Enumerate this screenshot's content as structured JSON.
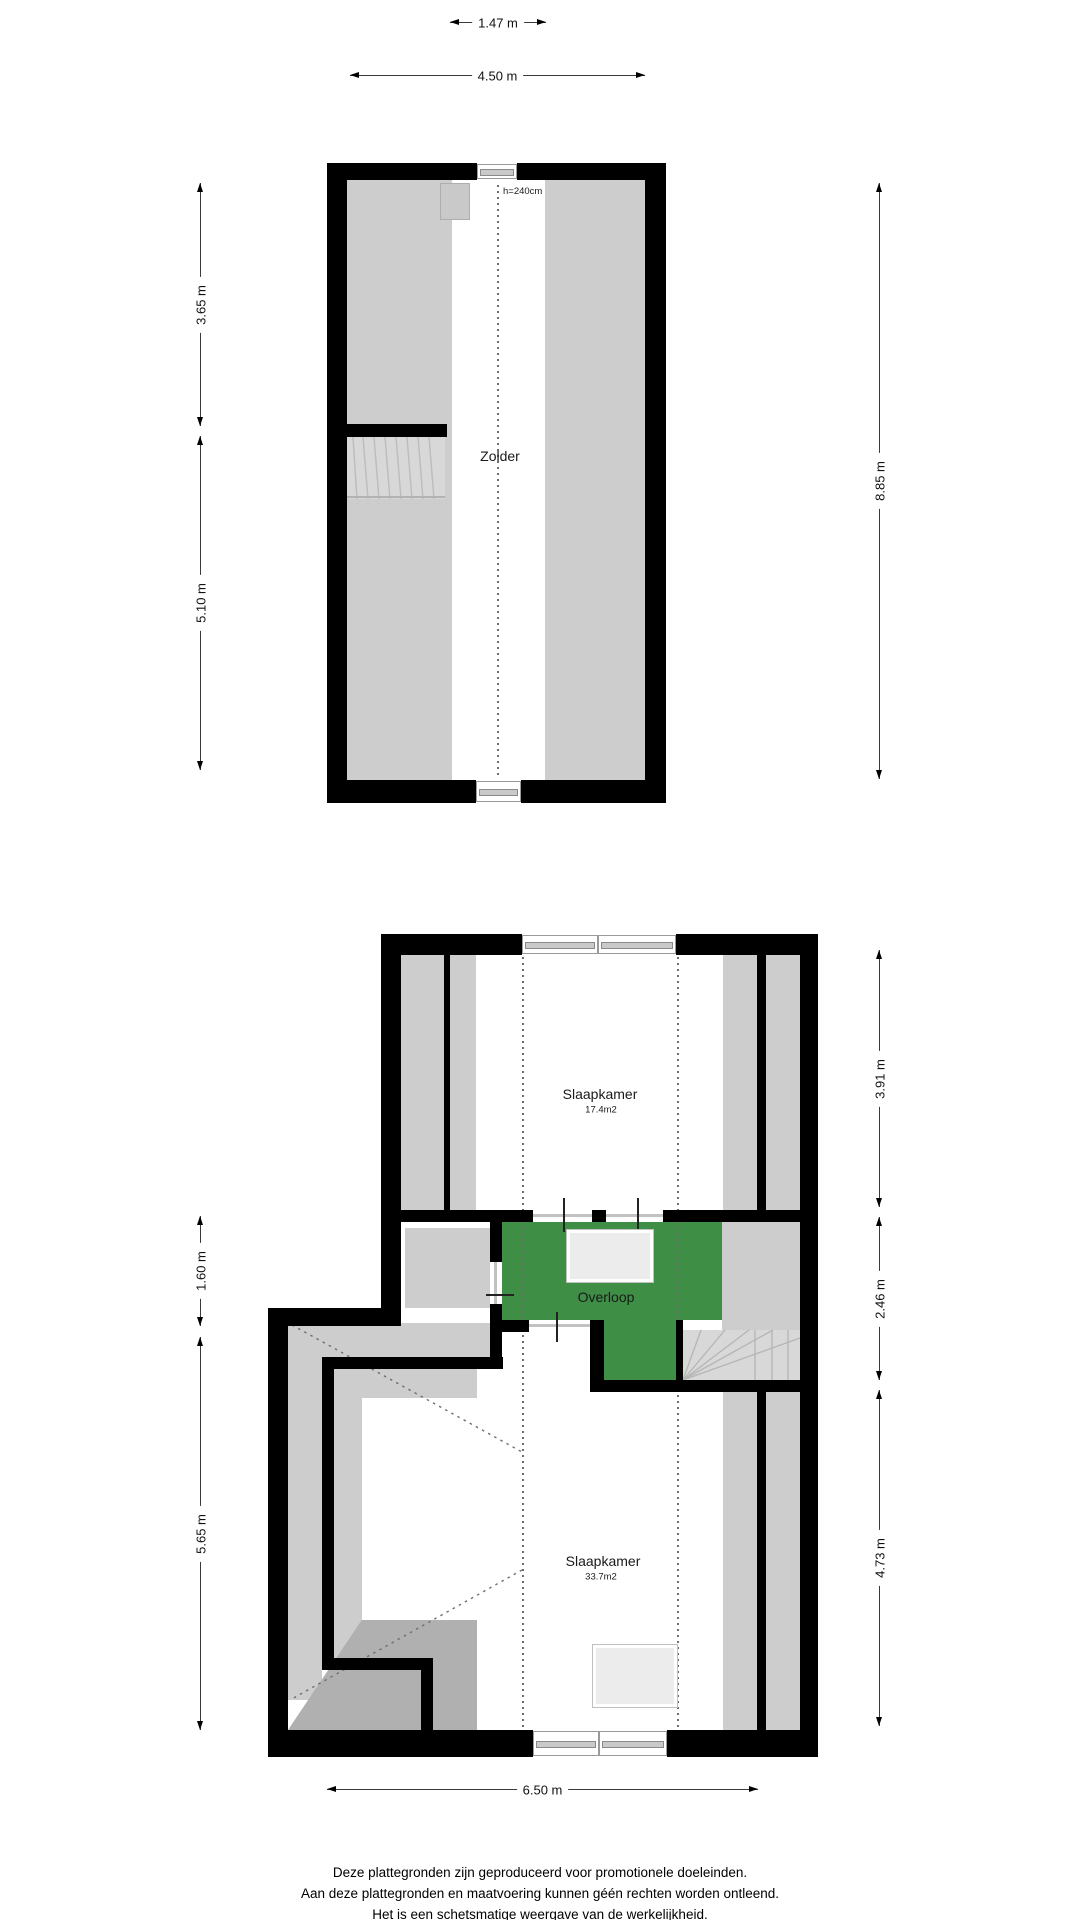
{
  "colors": {
    "wall": "#000000",
    "sloped_ceiling_gray": "#cdcdcd",
    "low_corner_gray": "#b0b0b0",
    "stairs_gray": "#d8d8d8",
    "overloop_green": "#3e8e45",
    "skylight_fill": "#ececec",
    "dotted_line": "#6e6e6e",
    "dimension_line": "#3a3a3a"
  },
  "attic_plan": {
    "room_label": "Zolder",
    "height_annotation": "h=240cm",
    "dimensions": {
      "top_inner": "1.47 m",
      "top_outer": "4.50 m",
      "left_upper": "3.65 m",
      "left_lower": "5.10 m",
      "right_full": "8.85 m"
    }
  },
  "floor_plan": {
    "rooms": {
      "bedroom_top": {
        "label": "Slaapkamer",
        "area": "17.4m2"
      },
      "landing": {
        "label": "Overloop"
      },
      "bedroom_bottom": {
        "label": "Slaapkamer",
        "area": "33.7m2"
      }
    },
    "dimensions": {
      "right_top": "3.91 m",
      "right_middle": "2.46 m",
      "right_bottom": "4.73 m",
      "left_upper": "1.60 m",
      "left_lower": "5.65 m",
      "bottom": "6.50 m"
    }
  },
  "footer": {
    "lines": [
      "Deze plattegronden zijn geproduceerd voor promotionele doeleinden.",
      "Aan deze plattegronden en maatvoering kunnen géén rechten worden ontleend.",
      "Het is een schetsmatige weergave van de werkelijkheid."
    ]
  }
}
